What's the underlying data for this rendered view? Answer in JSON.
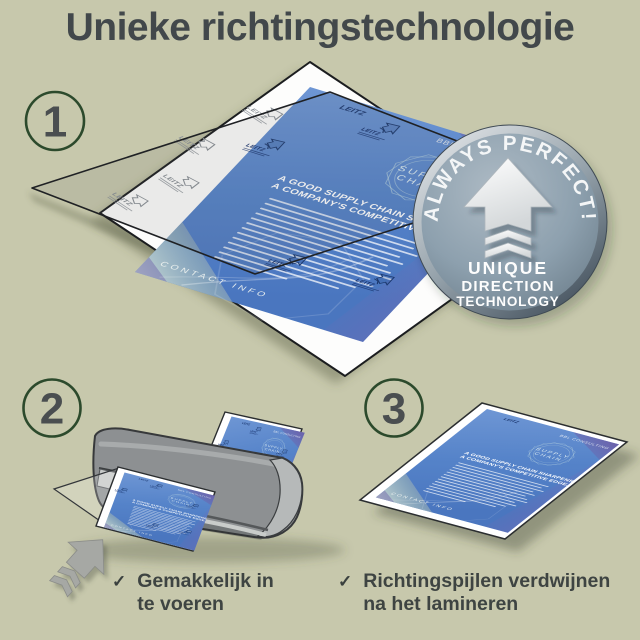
{
  "title": "Unieke richtingstechnologie",
  "steps": [
    {
      "number": "1"
    },
    {
      "number": "2"
    },
    {
      "number": "3"
    }
  ],
  "badge": {
    "curved_text": "ALWAYS PERFECT!",
    "line1": "UNIQUE",
    "line2": "DIRECTION",
    "line3": "TECHNOLOGY"
  },
  "document": {
    "brand": "LEITZ",
    "company": "BBL CONSULTING",
    "emblem_line1": "SUPPLY",
    "emblem_line2": "CHAIN",
    "heading_line1": "A GOOD SUPPLY CHAIN SHARPENS",
    "heading_line2": "A COMPANY'S COMPETITIVE EDGE.",
    "footer": "CONTACT INFO"
  },
  "captions": [
    {
      "check": "✓",
      "line1": "Gemakkelijk in",
      "line2": "te voeren"
    },
    {
      "check": "✓",
      "line1": "Richtingspijlen verdwijnen",
      "line2": "na het lamineren"
    }
  ],
  "colors": {
    "background": "#c7c8ac",
    "heading_text": "#42484b",
    "step_circle_green": "#2c4a2c",
    "document_blue": "#5583c9",
    "badge_gray": "#8da0ae",
    "machine_gray": "#8d9092"
  }
}
